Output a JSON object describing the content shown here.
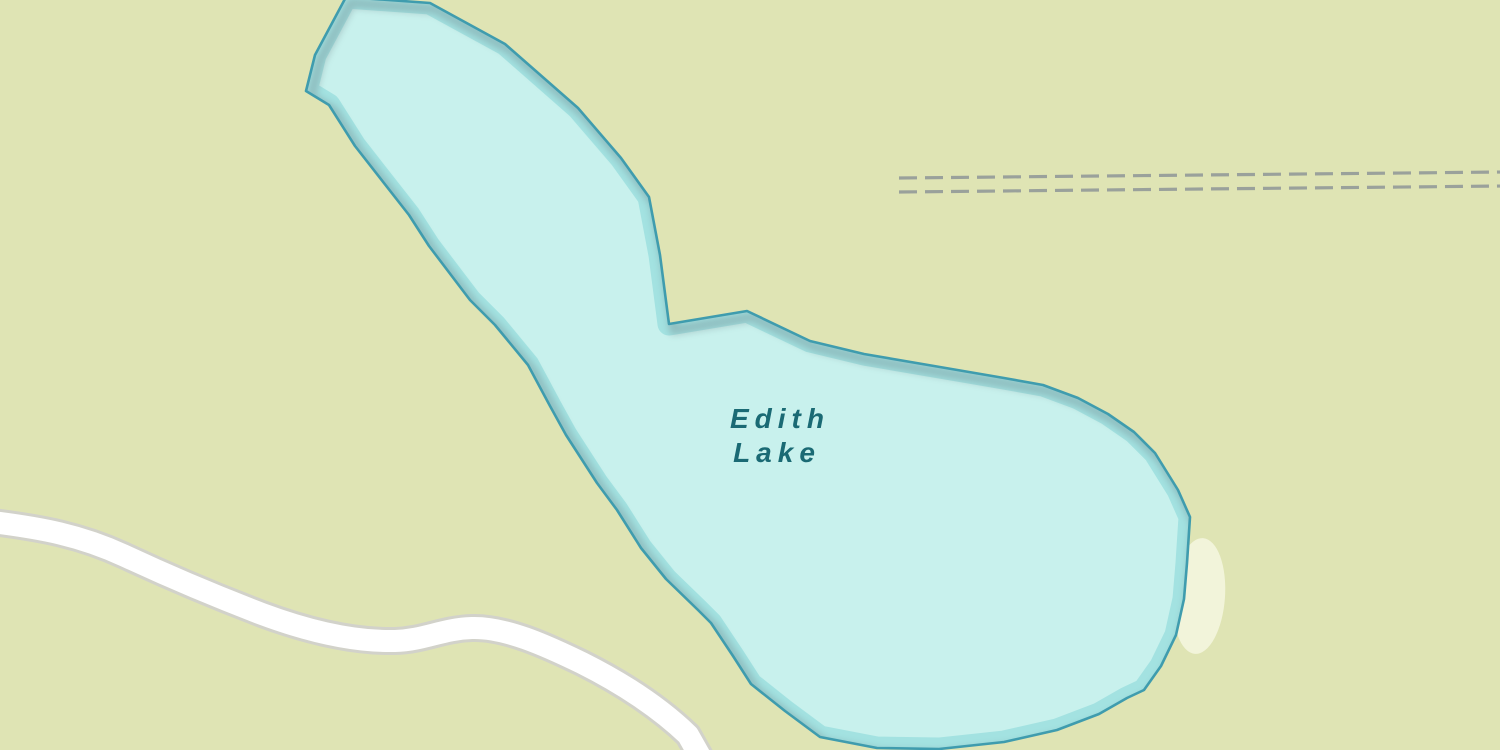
{
  "map": {
    "labels": {
      "lake": {
        "name": "Edith Lake",
        "line1": "Edith",
        "line2": "Lake"
      }
    },
    "features": {
      "water": "lake polygon",
      "road": "unlabeled white road (lower left)",
      "track": "double dashed track (upper right)",
      "sand": "small beach patch on east shore"
    }
  },
  "colors": {
    "land": "#dfe4b4",
    "water_fill": "#c8f1ed",
    "water_band": "#a3e2e1",
    "water_outline": "#3f9cae",
    "water_shadow": "#6e8086",
    "label_text": "#1a6a74",
    "road_fill": "#ffffff",
    "road_casing": "#d2d2ca",
    "railway_dash": "#9aa19b",
    "sand": "#f2f4da"
  }
}
